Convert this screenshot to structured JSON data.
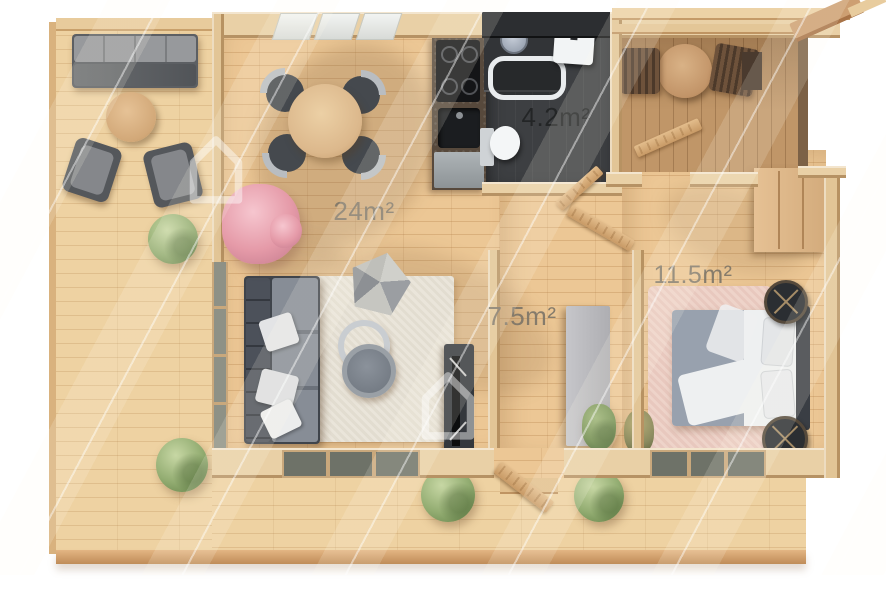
{
  "image_type": "3d-top-view-floor-plan-render",
  "rooms": {
    "living_dining": {
      "name": "living-dining-room",
      "area_label": "24m²"
    },
    "bathroom": {
      "name": "bathroom",
      "area_label": "4.2m²"
    },
    "hallway": {
      "name": "hallway",
      "area_label": "7.5m²"
    },
    "bedroom": {
      "name": "bedroom",
      "area_label": "11.5m²"
    }
  },
  "palette": {
    "background": "#ffffff",
    "deck_wood": "#eed2a2",
    "interior_floor": "#ecc795",
    "wall_wood": "#e9d0a6",
    "entry_terrace_floor": "#c09668",
    "bathroom_floor": "#3d3f42",
    "sofa_dark": "#3f444b",
    "sofa_seat": "#848a93",
    "rug_cream": "#eae5da",
    "bedroom_rug_pink": "#eed3c9",
    "bed_duvet": "#eef0f1",
    "blanket_gray": "#98a1ae",
    "bush_green": "#92ac71",
    "tree_pink": "#e59aa8",
    "label_gray": "#7d7568",
    "label_dark": "#26282b"
  },
  "furniture": {
    "outdoor_lounge": [
      "outdoor-sofa",
      "round-coffee-table",
      "lounge-chair",
      "lounge-chair",
      "bushes"
    ],
    "dining": [
      "round-dining-table",
      "dining-chairs-x4"
    ],
    "kitchen": [
      "cooktop",
      "sink",
      "counter",
      "base-cabinet"
    ],
    "bathroom": [
      "shower",
      "shower-head",
      "washbasin",
      "toilet",
      "door"
    ],
    "living": [
      "corner-sofa",
      "throw-pillows",
      "woven-pouf",
      "nesting-coffee-tables",
      "tv-console",
      "cream-rug"
    ],
    "hallway": [
      "storage-cabinet",
      "plant",
      "front-door"
    ],
    "bedroom": [
      "double-bed",
      "pillows",
      "nightstand",
      "nightstand",
      "wardrobe",
      "pink-rug",
      "plant"
    ],
    "entry_terrace": [
      "bistro-table",
      "terrace-chair",
      "terrace-chair",
      "pergola-beams"
    ]
  },
  "watermark": {
    "logo": "house-outline",
    "pattern": "diagonal-lines"
  }
}
